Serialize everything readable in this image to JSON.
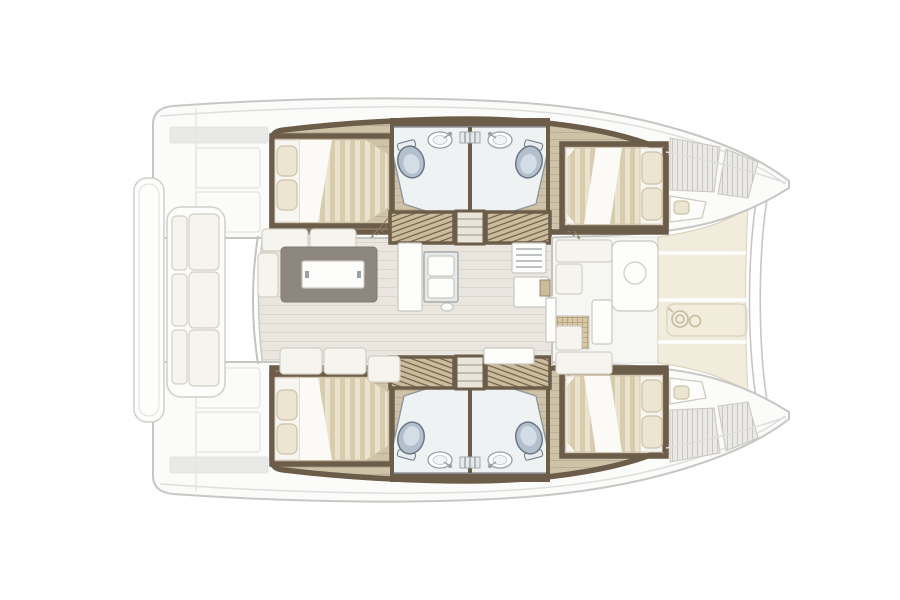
{
  "meta": {
    "title": "Catamaran interior floor plan",
    "description": "Top-down deck and accommodation plan of a four-cabin sailing catamaran: twin hulls with double cabins fore and aft, two bathrooms per hull, central saloon with galley and dining table, aft cockpit bench, forward cockpit lounge, foredeck with anchor windlass and bow crossbeam"
  },
  "colors": {
    "background": "#ffffff",
    "deck": "#fbfbfa",
    "deck_line": "#c7c7c5",
    "deck_inner": "#dedede",
    "panel_faint": "#e3e3e1",
    "stern_band": "#e9e9e7",
    "trim": "#6b5d49",
    "wood": "#cec2a8",
    "wood_line": "#bcaf94",
    "bath_floor": "#eff2f3",
    "bath_line": "#8e979e",
    "toilet": "#b2c0cd",
    "toilet_inner": "#d3dde5",
    "toilet_line": "#6a7683",
    "steel": "#9aa0a4",
    "steel_panel": "#e7e9e9",
    "grill": "#a8adb0",
    "mattress": "#eae3cf",
    "mattress_stripe": "#d8ccaf",
    "mattress_line": "#d4c9ae",
    "linen": "#f6f5ef",
    "linen_bright": "#fbfaf7",
    "pillow": "#ece5d1",
    "pillow_line": "#ccc2a6",
    "hatch": "#cabc9c",
    "hatch_line": "#6e6047",
    "tread_fill": "#e9e5da",
    "tread_line": "#b3aea1",
    "door_arc": "#8d7f67",
    "saloon_floor": "#eae6df",
    "saloon_line": "#dcd6ca",
    "saloon_border": "#c9c9c7",
    "sofa": "#f5f4ee",
    "sofa_line": "#d2cfc5",
    "white_panel": "#fdfdfc",
    "white_line": "#c9c7c0",
    "table_base": "#8e8780",
    "wood_box": "#cabb99",
    "wood_box_line": "#97886a",
    "foredeck": "#f1ecdc",
    "foredeck_line": "#ddd6c1",
    "inset_line": "#d9d1ba",
    "windlass": "#c5bb9e",
    "beam": "#c6c6c4",
    "wall": "#c3c3c0",
    "circle_mark": "#d3d3ce",
    "cockpit_floor": "#f6f6f3",
    "rib_base": "#ebe9e5",
    "rib_line": "#c8c6c1",
    "rattan": "#d8c9a6",
    "rattan_line": "#b29d76"
  },
  "vessel": {
    "orientation": {
      "bow": "right",
      "stern": "left"
    },
    "hulls": [
      {
        "id": "port-hull",
        "position": "top",
        "spaces": [
          "aft double cabin",
          "aft bathroom with toilet and washbasin",
          "forward bathroom with toilet and washbasin",
          "forward double cabin",
          "companionway steps with louvered lockers",
          "bow hatch panels and berth pad"
        ]
      },
      {
        "id": "starboard-hull",
        "position": "bottom",
        "spaces": [
          "aft double cabin",
          "aft bathroom with toilet and washbasin",
          "forward bathroom with toilet and washbasin",
          "forward double cabin",
          "companionway steps with louvered lockers",
          "bow hatch panels and berth pad"
        ]
      }
    ],
    "center": {
      "aft_cockpit": {
        "features": [
          "transom platform",
          "bench seating with cushions"
        ]
      },
      "saloon": {
        "features": [
          "dining table",
          "sofa cushions",
          "galley double sink",
          "stove",
          "cabinet columns",
          "aft sliding door"
        ]
      },
      "forward_cockpit": {
        "features": [
          "lounge panel with cup recess",
          "bench seating",
          "rattan side table",
          "forward sliding door"
        ]
      },
      "foredeck": {
        "features": [
          "sun deck panels",
          "anchor windlass",
          "bow crossbeam"
        ]
      }
    },
    "fixture_counts": {
      "double_beds": 4,
      "bathrooms": 4,
      "toilets": 4,
      "washbasins": 4,
      "companionways": 2
    }
  }
}
